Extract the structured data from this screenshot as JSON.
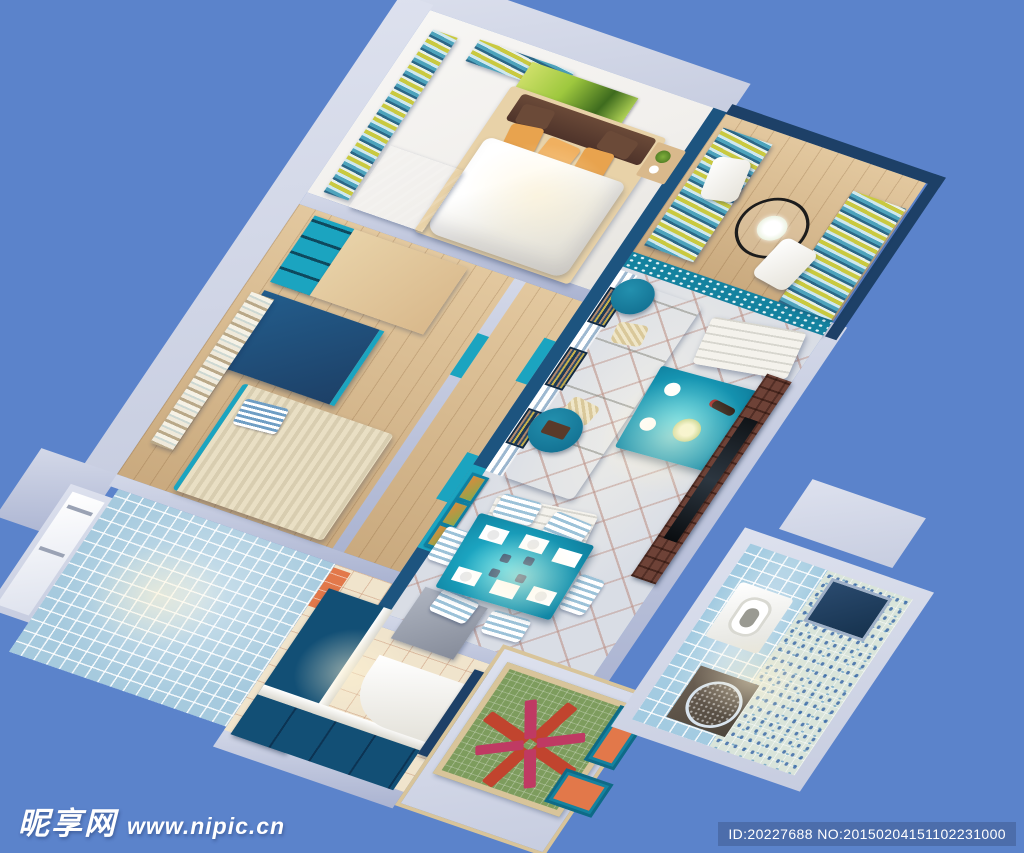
{
  "image": {
    "type": "3d-isometric-apartment-render",
    "description": "Top-down cutaway 3D render of a Mediterranean blue-and-teal style apartment: master bedroom, kids bedroom, balcony, living room, dining area, kitchen, two mosaic-tiled bathrooms, entry rug",
    "background_color": "#5b83cb"
  },
  "watermark": {
    "site_name": "昵享网",
    "site_url": "www.nipic.cn"
  },
  "id_bar": {
    "text": "ID:20227688 NO:20150204151102231000",
    "bg": "#4c6dab"
  },
  "palette": {
    "bg": "#5b83cb",
    "wallLight": "#c7cde0",
    "wallMid": "#aab3d1",
    "navy": "#1d547f",
    "navyDeep": "#1d4067",
    "tealBright": "#1ba4c0",
    "tealMid": "#14829f",
    "tealDark": "#124f75",
    "wood": "#d9b98c",
    "woodLight": "#e8d2a8",
    "marble": "#f1efec",
    "tileBase": "#d9dde5",
    "cream": "#f0e4cc",
    "mosaic": "#a6cade",
    "mosaicDeep": "#7fb0cc",
    "brick": "#6e4237",
    "orange": "#e8a34e",
    "orangeTile": "#e2784a",
    "artGreen": "#9ec83e",
    "rugGreen": "#7d9c5d",
    "rugRed": "#c1442e",
    "rugPink": "#bf3a63",
    "rugTan": "#d8c49a",
    "furnWhite": "#f4f2ec",
    "idBg": "#4c6dab",
    "curtTeal": "#4da3bc",
    "curtLight": "#cfe8ee",
    "curtYellow": "#c9c940",
    "curtNavy": "#2c6787"
  },
  "rooms": [
    "master-bedroom",
    "kids-bedroom",
    "balcony",
    "living-room",
    "dining-area",
    "hallway",
    "kitchen",
    "bathroom-blue-tile",
    "bathroom-mosaic",
    "entry-porch"
  ]
}
